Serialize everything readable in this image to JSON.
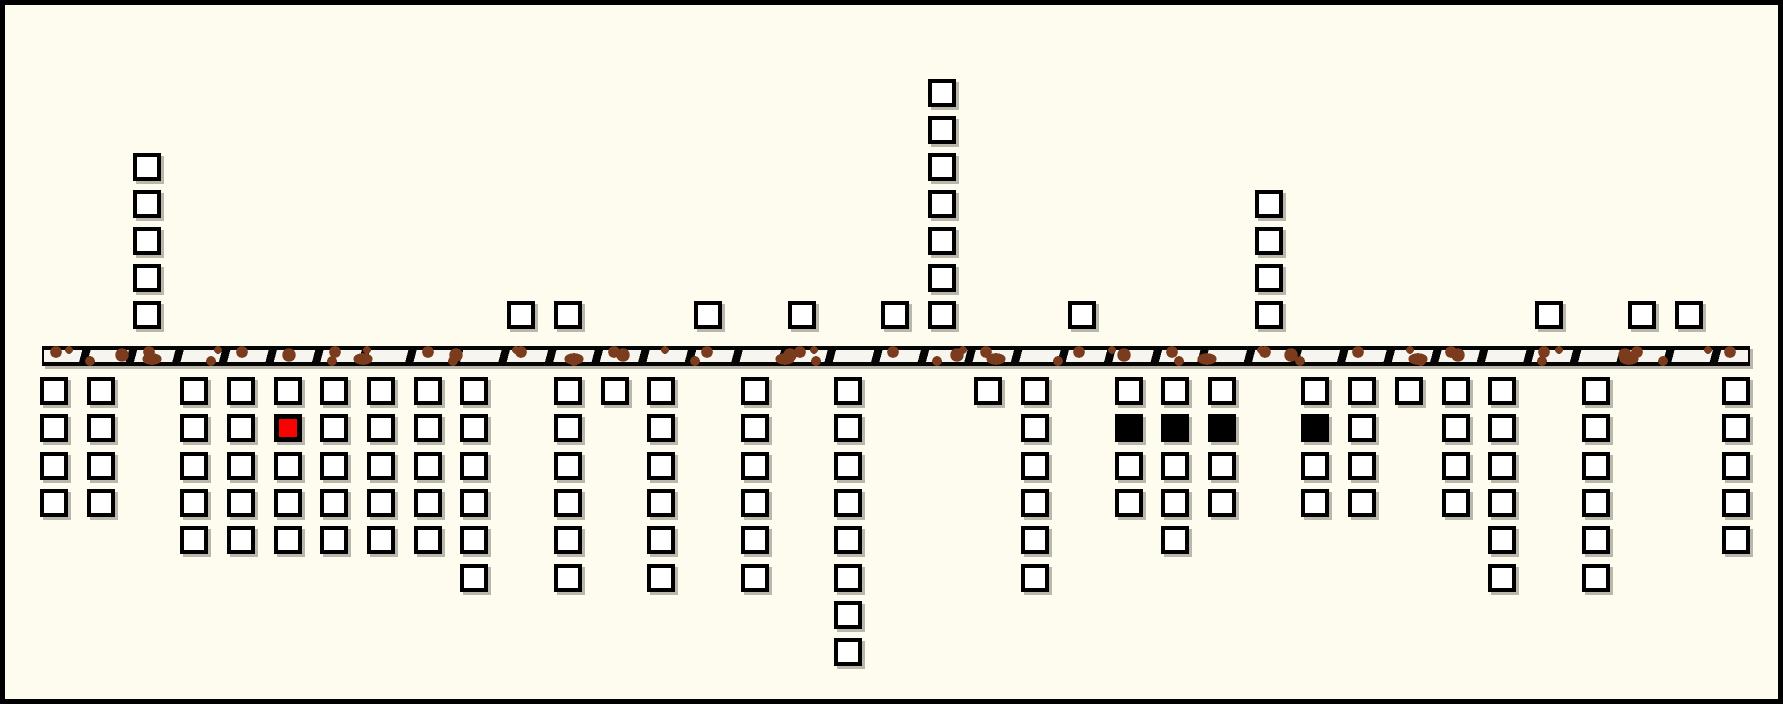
{
  "figure": {
    "description": "Schematic diagram: open squares stacked in columns above and below a horizontal segmented band; one red square below the band and four black filled squares below the band.",
    "colors": {
      "background": "#FDFCEF",
      "square_stroke": "#000000",
      "square_fill": "#FFFFFF",
      "square_shadow": "rgba(84,82,72,0.40)",
      "highlight_red": "#F70400",
      "filled_black": "#000000",
      "band_black": "#050505",
      "band_white": "#F7F5F0",
      "band_brown": "#7B3B1D"
    },
    "band": {
      "x": 37,
      "y": 341,
      "width": 1708,
      "height": 20
    },
    "layout": {
      "column_origin_x": 35,
      "column_pitch": 46.72,
      "square_size": 28,
      "below_first_row_y": 372,
      "below_row_pitch": 37.3,
      "above_first_row_y": 296,
      "above_row_pitch": 37.0
    },
    "above_columns": [
      {
        "k": 2,
        "count": 5
      },
      {
        "k": 10,
        "count": 1
      },
      {
        "k": 11,
        "count": 1
      },
      {
        "k": 14,
        "count": 1
      },
      {
        "k": 16,
        "count": 1
      },
      {
        "k": 18,
        "count": 1
      },
      {
        "k": 19,
        "count": 7
      },
      {
        "k": 22,
        "count": 1
      },
      {
        "k": 26,
        "count": 4
      },
      {
        "k": 32,
        "count": 1
      },
      {
        "k": 34,
        "count": 1
      },
      {
        "k": 35,
        "count": 1
      }
    ],
    "below_columns": [
      {
        "k": 0,
        "count": 4
      },
      {
        "k": 1,
        "count": 4
      },
      {
        "k": 3,
        "count": 5
      },
      {
        "k": 4,
        "count": 5
      },
      {
        "k": 5,
        "count": 5,
        "special_row": 2,
        "special_color": "red"
      },
      {
        "k": 6,
        "count": 5
      },
      {
        "k": 7,
        "count": 5
      },
      {
        "k": 8,
        "count": 5
      },
      {
        "k": 9,
        "count": 6
      },
      {
        "k": 11,
        "count": 6
      },
      {
        "k": 12,
        "count": 1
      },
      {
        "k": 13,
        "count": 6
      },
      {
        "k": 15,
        "count": 6
      },
      {
        "k": 17,
        "count": 8
      },
      {
        "k": 20,
        "count": 1
      },
      {
        "k": 21,
        "count": 6
      },
      {
        "k": 23,
        "count": 4,
        "special_row": 2,
        "special_color": "black"
      },
      {
        "k": 24,
        "count": 5,
        "special_row": 2,
        "special_color": "black"
      },
      {
        "k": 25,
        "count": 4,
        "special_row": 2,
        "special_color": "black"
      },
      {
        "k": 27,
        "count": 4,
        "special_row": 2,
        "special_color": "black"
      },
      {
        "k": 28,
        "count": 4
      },
      {
        "k": 29,
        "count": 1
      },
      {
        "k": 30,
        "count": 4
      },
      {
        "k": 31,
        "count": 6
      },
      {
        "k": 33,
        "count": 6
      },
      {
        "k": 36,
        "count": 5
      }
    ],
    "totals": {
      "squares_above": 25,
      "squares_below": 121
    }
  }
}
